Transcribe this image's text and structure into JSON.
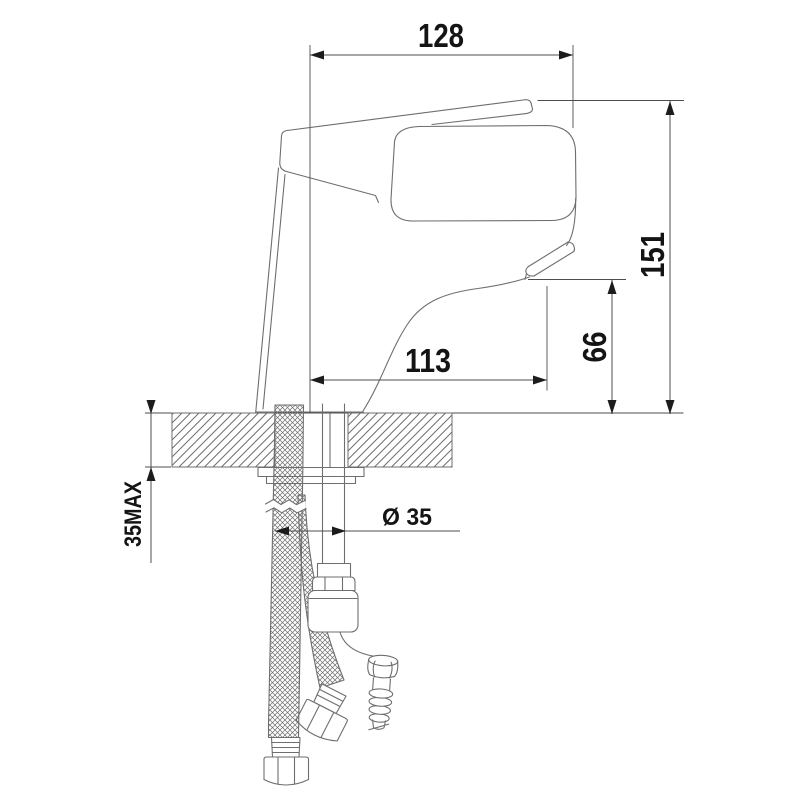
{
  "drawing": {
    "kind": "faucet-installation-technical-drawing"
  },
  "dimensions": {
    "top_width": "128",
    "total_height": "151",
    "spout_height": "66",
    "spout_reach": "113",
    "max_counter_thickness": "35MAX",
    "hole_diameter": "Ø 35"
  },
  "colors": {
    "line": "#6e6e6e",
    "dim": "#4d4d4d",
    "arrow": "#1c1c1c",
    "text": "#141414",
    "background": "#ffffff"
  }
}
